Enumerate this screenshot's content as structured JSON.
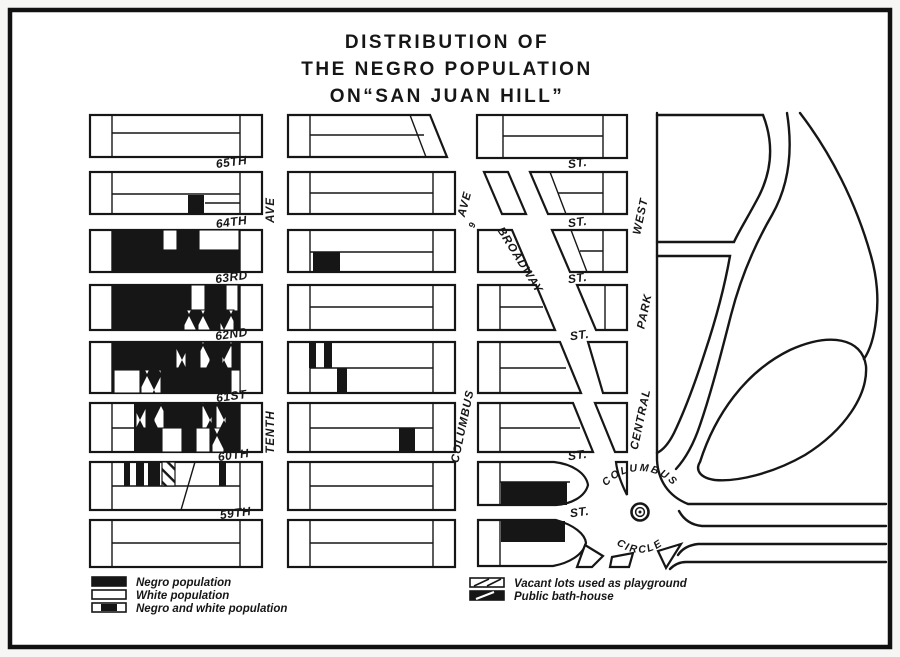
{
  "title": {
    "line1": "DISTRIBUTION OF",
    "line2": "THE NEGRO POPULATION",
    "line3": "ON“SAN JUAN HILL”"
  },
  "streets": {
    "left": [
      "65TH",
      "64TH",
      "63RD",
      "62ND",
      "61ST",
      "60TH",
      "59TH"
    ],
    "st": [
      "ST.",
      "ST.",
      "ST.",
      "ST.",
      "ST.",
      "ST."
    ]
  },
  "avenues": {
    "tenth": "TENTH",
    "tenth_ave": "AVE",
    "ninth_ave": "AVE",
    "ninth_num": "9",
    "columbus": "COLUMBUS",
    "central": "CENTRAL",
    "park": "PARK",
    "west": "WEST"
  },
  "broadway": {
    "label": "BROADWAY"
  },
  "circle": {
    "top": "COLUMBUS",
    "bottom": "CIRCLE"
  },
  "legend": {
    "left": [
      {
        "swatch": "negro-population",
        "label": "Negro population"
      },
      {
        "swatch": "white-population",
        "label": "White population"
      },
      {
        "swatch": "negro-and-white",
        "label": "Negro and white population"
      }
    ],
    "right": [
      {
        "swatch": "vacant-playground",
        "label": "Vacant lots used as playground"
      },
      {
        "swatch": "public-bath-house",
        "label": "Public bath-house"
      }
    ]
  },
  "map_data": {
    "type": "map",
    "subject": "Distribution of the Negro population on San Juan Hill",
    "orientation": "north at top, Central Park at right, Columbus Circle at lower right",
    "avenues_west_to_east": [
      "Tenth Ave",
      "Columbus Ave (9 Ave)",
      "Broadway (diagonal)",
      "Central Park West"
    ],
    "cross_streets_north_to_south": [
      "65th",
      "64th",
      "63rd",
      "62nd",
      "61st",
      "60th",
      "59th"
    ],
    "block_shading": [
      {
        "block": "Tenth Ave column, 65th-66th",
        "shading": "white"
      },
      {
        "block": "Tenth Ave column, 64th-65th",
        "shading": "white with one small Negro lot"
      },
      {
        "block": "Tenth Ave column, 63rd-64th",
        "shading": "predominantly Negro with two white lots"
      },
      {
        "block": "Tenth Ave column, 62nd-63rd",
        "shading": "predominantly Negro with Negro-and-white lots"
      },
      {
        "block": "Tenth Ave column, 61st-62nd",
        "shading": "predominantly Negro with mixed lots and white corner"
      },
      {
        "block": "Tenth Ave column, 60th-61st",
        "shading": "Negro with mixed and white lots"
      },
      {
        "block": "Tenth Ave column, 59th-60th",
        "shading": "alternating Negro, white, mixed and playground lots"
      },
      {
        "block": "Tenth Ave column, 58th-59th",
        "shading": "white"
      },
      {
        "block": "Columbus Ave column, 63rd-64th",
        "shading": "white with one Negro section"
      },
      {
        "block": "Columbus Ave column, 61st-62nd",
        "shading": "white with three Negro lots"
      },
      {
        "block": "Columbus Ave column, 60th-61st",
        "shading": "white with one Negro lot"
      },
      {
        "block": "near Columbus Circle, 59th-60th",
        "shading": "Negro section"
      },
      {
        "block": "near Columbus Circle, 58th-59th",
        "shading": "Negro section"
      },
      {
        "block": "all other blocks",
        "shading": "white"
      }
    ]
  },
  "colors": {
    "ink": "#161616",
    "paper": "#ffffff",
    "page_bg": "#e9e9e9"
  }
}
